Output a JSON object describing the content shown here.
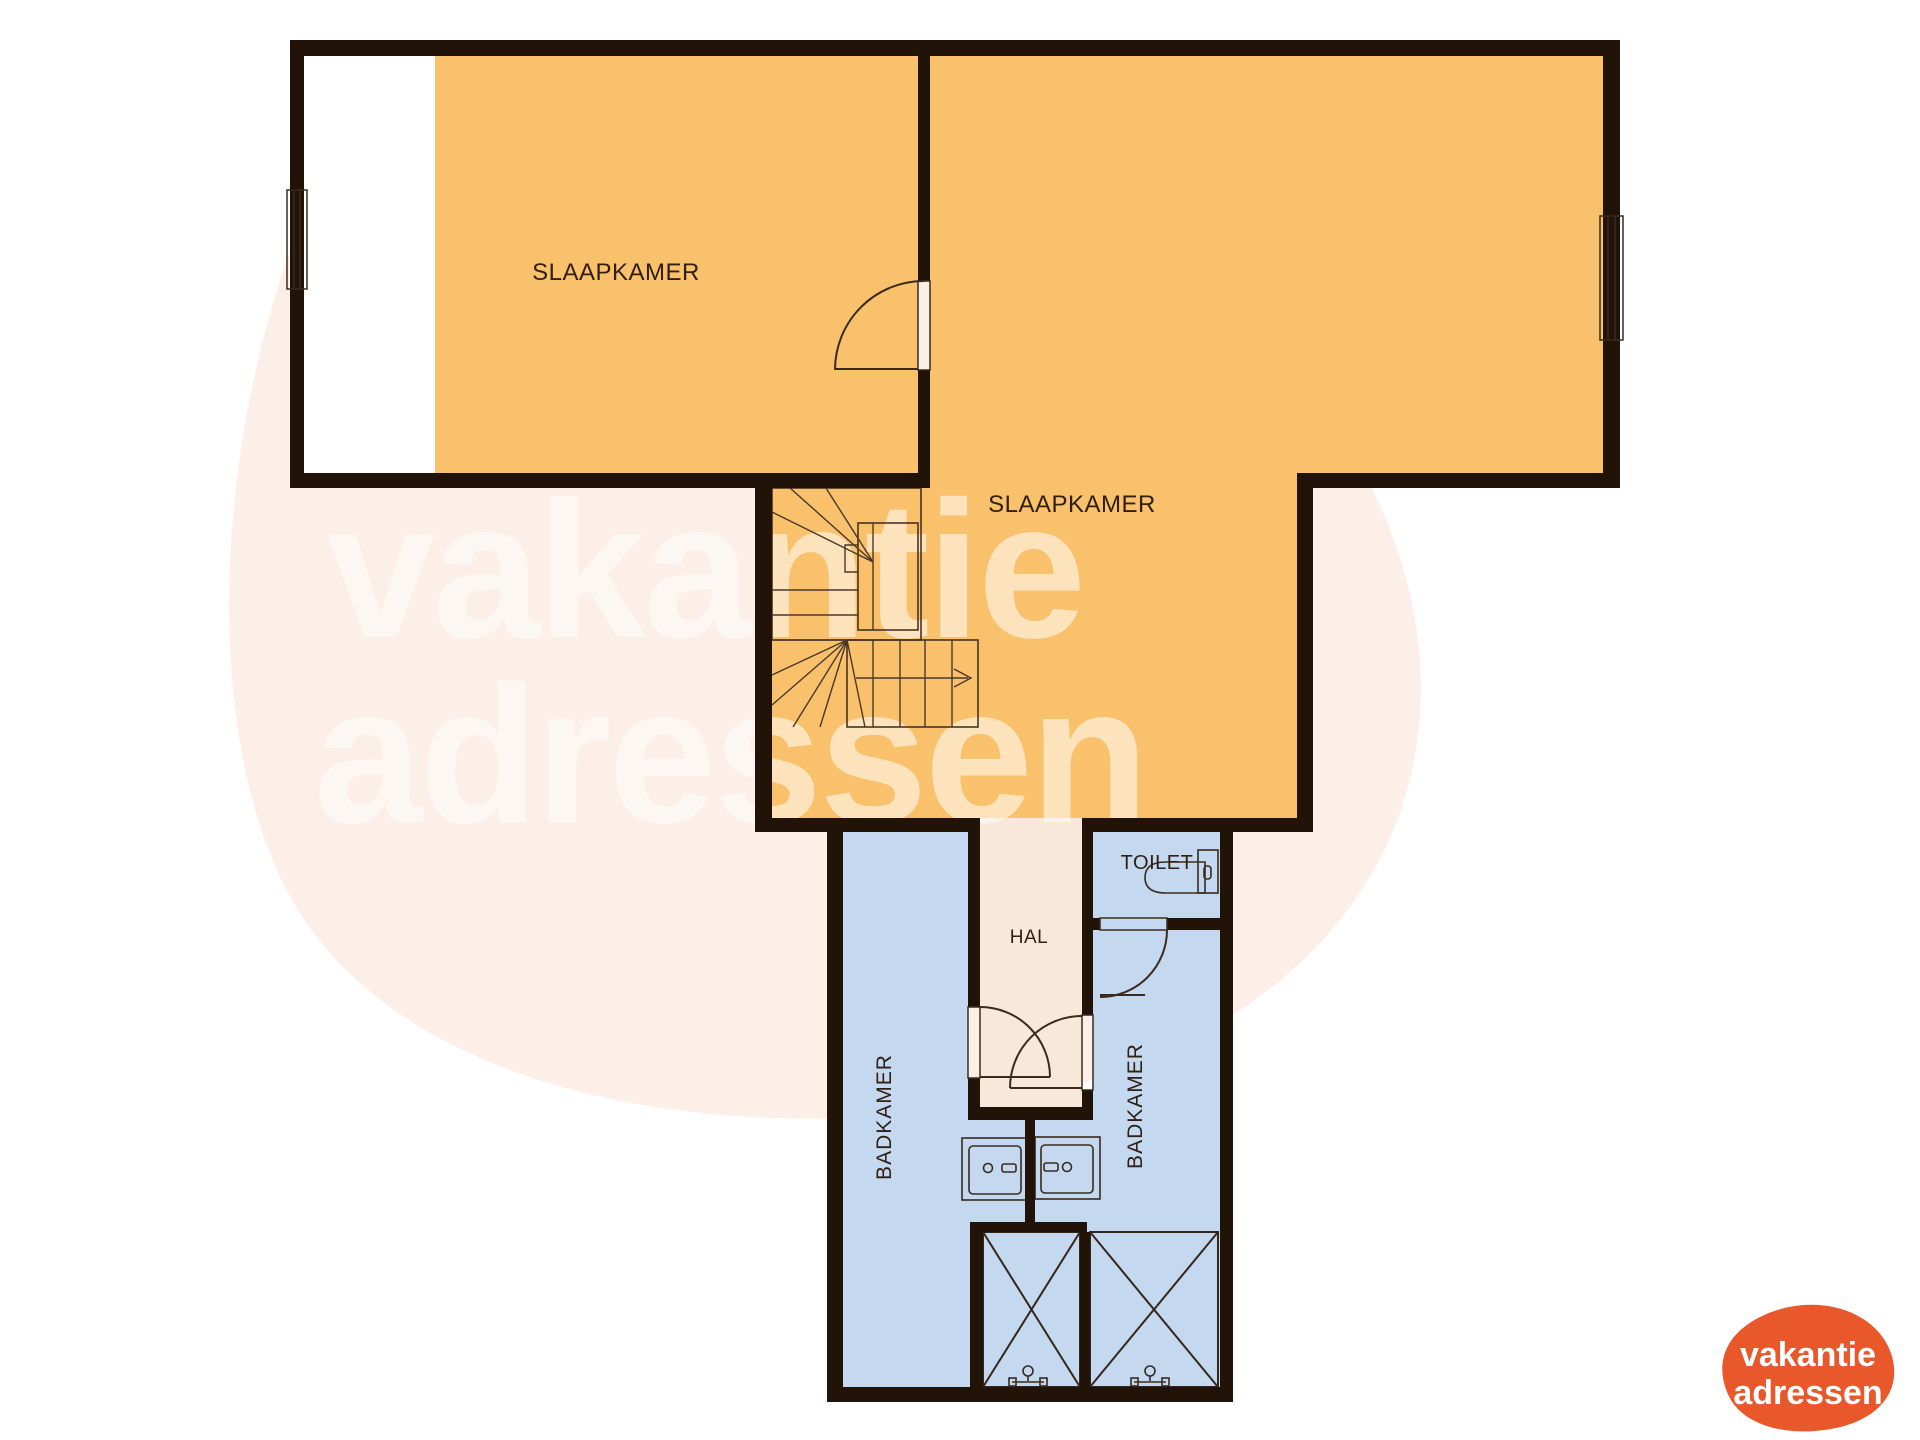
{
  "plan": {
    "rooms": {
      "slaapkamer_left": "SLAAPKAMER",
      "slaapkamer_right": "SLAAPKAMER",
      "toilet": "TOILET",
      "hal": "HAL",
      "badkamer_left": "BADKAMER",
      "badkamer_right": "BADKAMER"
    }
  },
  "watermark": {
    "line1": "vakantie",
    "line2": "adressen"
  },
  "logo": {
    "line1": "vakantie",
    "line2": "adressen"
  },
  "colors": {
    "background": "#ffffff",
    "blob": "#fcefe8",
    "bedroom": "#f9c16b",
    "bathroom": "#c4d8ef",
    "hall": "#f7e8da",
    "stairs": "#f3eae1",
    "low_headroom": "#ffffff",
    "wall": "#221309",
    "line": "#3b2a1d",
    "opening": "#ffffff",
    "fixture": "#d9e6f6",
    "cistern": "#eef4fc",
    "label": "#2f2013",
    "watermark_text": "#ffffff",
    "logo_orange": "#e8582b",
    "logo_text": "#ffffff"
  }
}
